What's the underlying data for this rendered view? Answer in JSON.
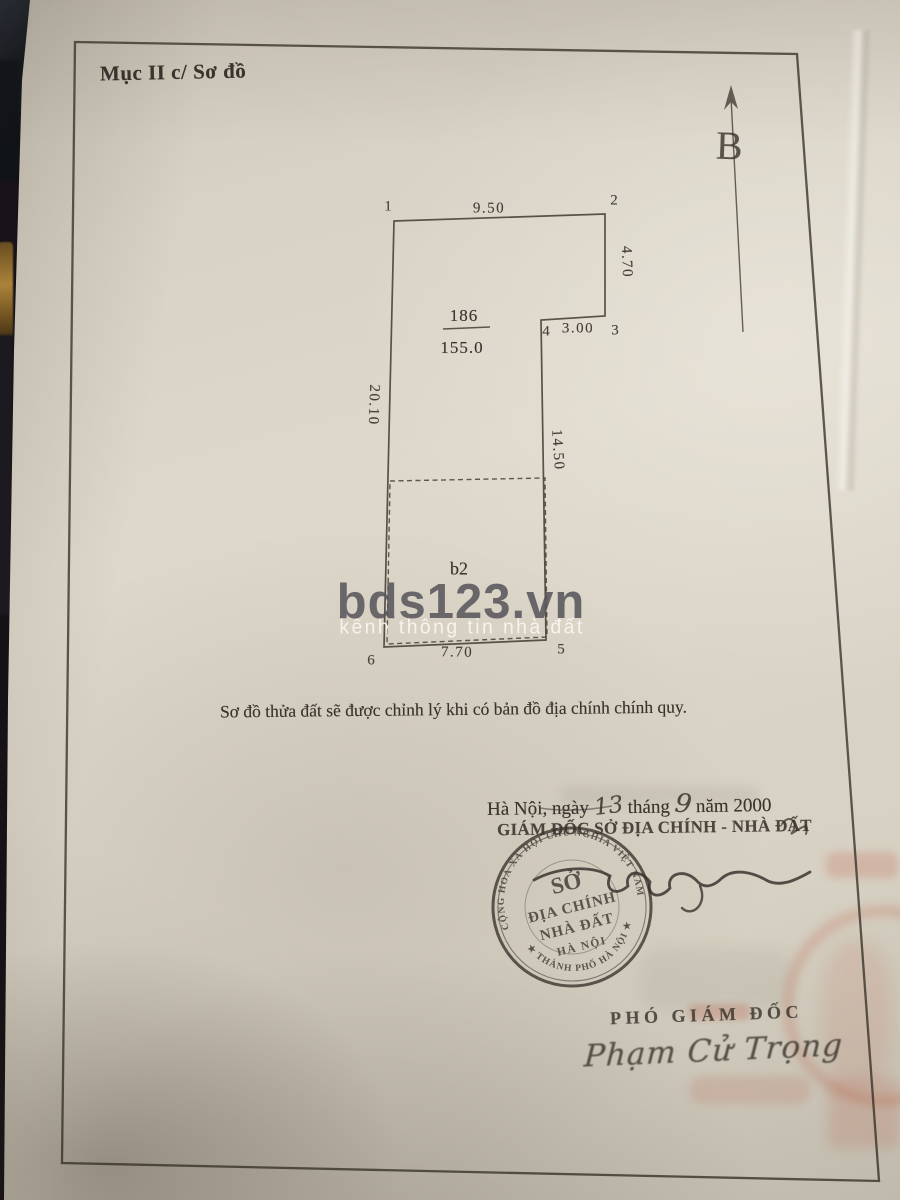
{
  "document": {
    "section_title": "Mục II c/ Sơ đồ",
    "north_label": "B",
    "caption": "Sơ đồ thửa đất sẽ được chỉnh lý khi có bản đồ địa chính chính quy.",
    "date": {
      "place_prefix": "Hà Nội, ngày",
      "day_handwritten": "13",
      "month_word": "tháng",
      "month_handwritten": "9",
      "year_text": "năm 2000"
    },
    "authority_title": "GIÁM ĐỐC SỞ ĐỊA CHÍNH - NHÀ ĐẤT",
    "deputy_title": "PHÓ GIÁM ĐỐC",
    "deputy_signature_name": "Phạm Cử Trọng"
  },
  "parcel": {
    "number": "186",
    "area": "155.0",
    "zone_label": "b2",
    "vertices": [
      "1",
      "2",
      "3",
      "4",
      "5",
      "6"
    ],
    "dimensions": {
      "top": "9.50",
      "right_upper": "4.70",
      "step": "3.00",
      "right_lower": "14.50",
      "left": "20.10",
      "bottom": "7.70"
    }
  },
  "stamp": {
    "line1": "SỞ",
    "line2": "ĐỊA CHÍNH",
    "line3": "NHÀ ĐẤT",
    "line4": "HÀ NỘI",
    "ring_text_top": "CỘNG HOÀ XÃ HỘI CHỦ NGHĨA VIỆT NAM",
    "ring_text_bottom": "★ THÀNH PHỐ HÀ NỘI ★"
  },
  "watermark": {
    "brand": "bds123.vn",
    "tagline": "kênh thông tin nhà đất"
  },
  "colors": {
    "ink": "#38332b",
    "paper": "#d8d2c5",
    "watermark_brand": "#58575b",
    "stamp_ink": "#3b362f",
    "red_bleed": "#c1563e"
  }
}
